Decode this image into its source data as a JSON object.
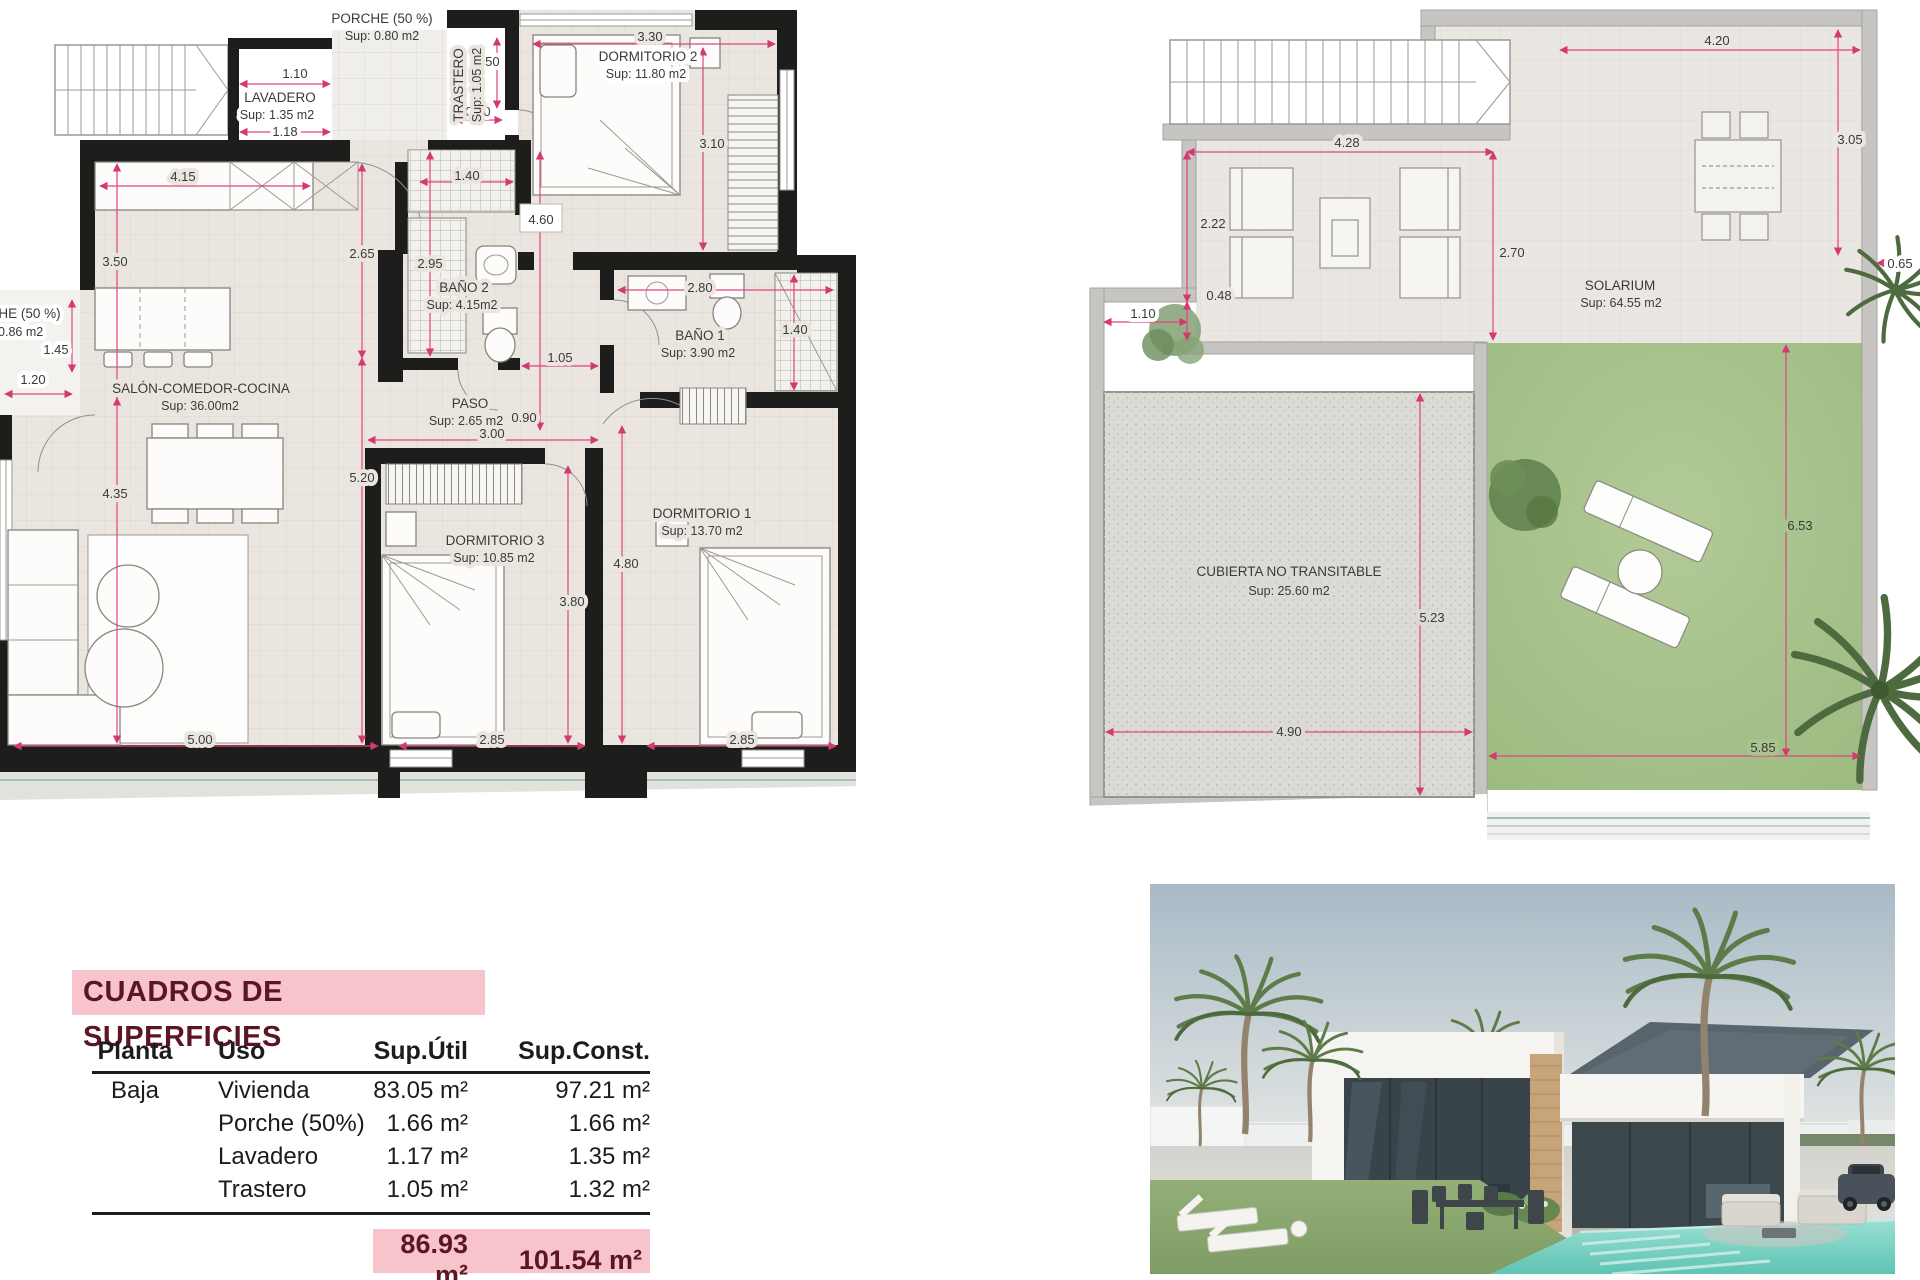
{
  "colors": {
    "wall": "#1d1d1b",
    "dim_pink": "#e0447f",
    "floor": "#eae6df",
    "gray_wall": "#c6c5c1",
    "lawn_green": "#a9c48e",
    "cubierta_gray": "#dcdad5",
    "table_pink": "#f6c4ca",
    "table_maroon": "#5c1523",
    "pool_teal": "#7fd4c4"
  },
  "plan_left": {
    "rooms": {
      "porche_top": {
        "name": "PORCHE (50 %)",
        "sup": "Sup: 0.80 m2"
      },
      "lavadero": {
        "name": "LAVADERO",
        "sup": "Sup: 1.35 m2"
      },
      "trastero": {
        "name": "TRASTERO",
        "sup": "Sup: 1.05 m2"
      },
      "dormitorio2": {
        "name": "DORMITORIO 2",
        "sup": "Sup: 11.80 m2"
      },
      "bano2": {
        "name": "BAÑO 2",
        "sup": "Sup: 4.15m2"
      },
      "bano1": {
        "name": "BAÑO 1",
        "sup": "Sup: 3.90 m2"
      },
      "paso": {
        "name": "PASO",
        "sup": "Sup: 2.65 m2"
      },
      "salon": {
        "name": "SALÓN-COMEDOR-COCINA",
        "sup": "Sup: 36.00m2"
      },
      "dormitorio3": {
        "name": "DORMITORIO 3",
        "sup": "Sup: 10.85 m2"
      },
      "dormitorio1": {
        "name": "DORMITORIO 1",
        "sup": "Sup: 13.70 m2"
      },
      "porche_left": {
        "name": "PORCHE (50 %)",
        "sup": "Sup: 0.86 m2"
      }
    },
    "dims": {
      "lav_top": "1.10",
      "lav_bot": "1.18",
      "tras_h": "1.50",
      "tras_w": "0.80",
      "dorm2_w": "3.30",
      "dorm2_h": "3.10",
      "cocina": "4.15",
      "salon_v1": "3.50",
      "salon_v2": "4.35",
      "col2_v1": "2.65",
      "col2_v2": "5.20",
      "armario2": "1.40",
      "pasillo": "4.60",
      "bano2_h": "2.95",
      "bano1_w": "2.80",
      "bano1_h": "1.40",
      "paso_w": "1.05",
      "puerta": "0.90",
      "paso_l": "3.00",
      "dorm3_v": "3.80",
      "dorm1_v": "4.80",
      "porche_izq_v": "1.45",
      "porche_izq_h": "1.20",
      "bottom1": "5.00",
      "bottom2": "2.85",
      "bottom3": "2.85"
    }
  },
  "plan_right": {
    "rooms": {
      "solarium": {
        "name": "SOLARIUM",
        "sup": "Sup: 64.55 m2"
      },
      "cubierta": {
        "name": "CUBIERTA NO TRANSITABLE",
        "sup": "Sup: 25.60 m2"
      }
    },
    "dims": {
      "top": "4.20",
      "right_v": "3.05",
      "stairs": "4.28",
      "left_v": "2.22",
      "mid_v": "2.70",
      "small_v": "0.48",
      "left_w": "1.10",
      "wall": "0.65",
      "cub_v": "5.23",
      "cub_w": "4.90",
      "lawn_v": "6.53",
      "lawn_w": "5.85"
    }
  },
  "table": {
    "title": "CUADROS DE SUPERFICIES",
    "headers": {
      "planta": "Planta",
      "uso": "Uso",
      "util": "Sup.Útil",
      "const": "Sup.Const."
    },
    "planta": "Baja",
    "rows": [
      {
        "uso": "Vivienda",
        "util": "83.05 m²",
        "const": "97.21 m²"
      },
      {
        "uso": "Porche (50%)",
        "util": "1.66 m²",
        "const": "1.66 m²"
      },
      {
        "uso": "Lavadero",
        "util": "1.17 m²",
        "const": "1.35 m²"
      },
      {
        "uso": "Trastero",
        "util": "1.05 m²",
        "const": "1.32 m²"
      }
    ],
    "total_util": "86.93 m²",
    "total_const": "101.54 m²"
  }
}
